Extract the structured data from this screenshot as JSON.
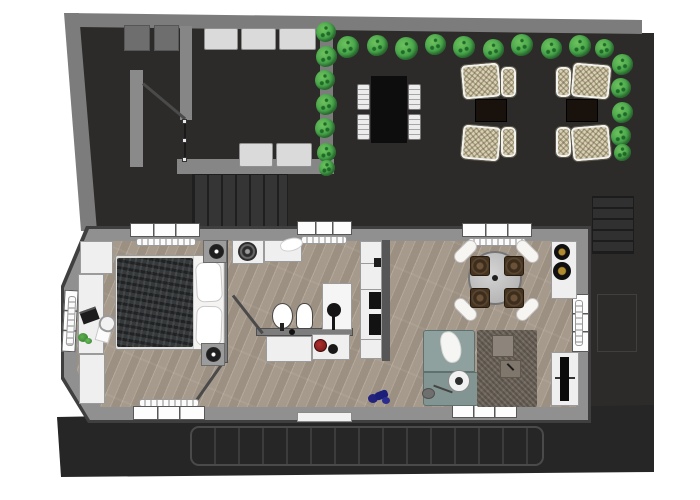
{
  "scene": {
    "type": "floor-plan-rendering",
    "description": "Top-down 3D architectural rendering of a one-bedroom apartment with a walled terrace courtyard, garden patio, hedges, outdoor lounge furniture and a rear deck",
    "background_color": "#ffffff",
    "visible_text": []
  },
  "palette": {
    "terrace_floor": "#2d2b29",
    "courtyard_wall": "#7c7c7c",
    "apartment_wall": "#909090",
    "wall_outline": "#3f3f3f",
    "wood_floor": "#a69a8c",
    "hedge_green": "#45a44a",
    "bench_light_gray": "#dadada",
    "wicker_tan": "#d8cfb4",
    "outdoor_table_black": "#0d0d0d",
    "side_table_dark_brown": "#19120c",
    "sofa_teal_gray": "#8fa19e",
    "rug_taupe": "#6f665c",
    "duvet_charcoal": "#36393b",
    "linen_white": "#f4f3f1",
    "accent_red": "#8e2020",
    "accent_blue": "#23237e",
    "burner_brass": "#b08c2e"
  },
  "terrace": {
    "areas": [
      "walled courtyard",
      "garden patio with benches",
      "hedge rows",
      "stair flights"
    ],
    "furniture": {
      "outdoor_dining_table": {
        "color": "#0d0d0d",
        "chairs": 4,
        "chair_color": "#ececec"
      },
      "lounge_groups": 2,
      "wicker_lounge_chairs": 8,
      "dark_side_tables": 2,
      "garden_benches": 5,
      "planters": 2
    },
    "hedges": {
      "top_row_bushes": 10,
      "left_column_bushes": 7,
      "right_column_bushes": 5
    }
  },
  "apartment": {
    "bedroom": {
      "furniture": [
        "double bed with charcoal duvet and white pillows",
        "two nightstands with black round lamps",
        "white desk-wardrobe run",
        "laptop",
        "desk chair",
        "papers",
        "potted plant"
      ],
      "windows": [
        "top window with radiator",
        "bottom window with radiator",
        "left window with radiator"
      ]
    },
    "bathroom": {
      "fixtures": [
        "washing machine",
        "counter with towel",
        "oval washbasin with faucet",
        "toilet",
        "shower column with black head",
        "vanity cabinets",
        "red knob",
        "black knob"
      ]
    },
    "kitchen": {
      "fixtures": [
        "tall white cabinet column",
        "two black built-in appliances"
      ]
    },
    "living_dining": {
      "furniture": [
        "round glass dining table",
        "four chairs with white cushions and dark seats",
        "white counter with two brass-center burners",
        "L-shaped teal-gray sofa with white throw",
        "round white floor lamp",
        "taupe rug",
        "two square coffee tables",
        "white TV sideboard with black TV",
        "french door with radiator",
        "blue object on floor",
        "gray pouf"
      ]
    },
    "doors": [
      "bedroom swing door",
      "bathroom swing door",
      "bottom entrance threshold",
      "right french door"
    ]
  },
  "deck": {
    "style": "dark plank deck with rounded slat frame",
    "stairs": true
  }
}
